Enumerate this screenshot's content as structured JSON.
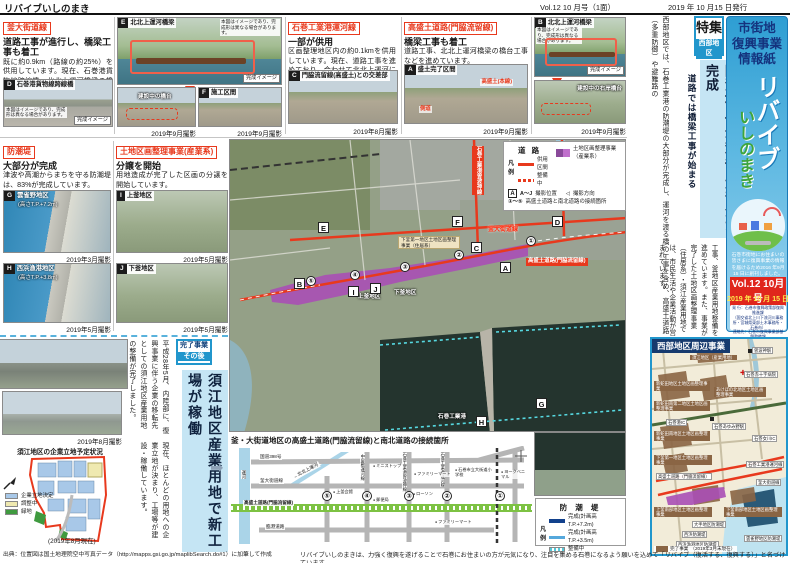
{
  "header": {
    "newsletter_name": "リバイブいしのまき",
    "volume": "Vol.12 10 月号（1面）",
    "issue_date": "2019 年 10 月15 日発行"
  },
  "articles": {
    "a1": {
      "label": "釜大街道線",
      "headline": "道路工事が進行し、橋梁工事も着工",
      "body": "既に約0.9km（路線の約25%）を供用しています。現在、石巻港貨物線跨線橋、北北上運河橋梁の橋台工事などを進めています。"
    },
    "a2": {
      "label": "石巻工業港運河線",
      "headline": "一部が供用",
      "body": "区画整理地区内の約0.1kmを供用しています。現在、道路工事を進めており、合わせて北北上運河に関わる橋梁の整備も進めています。"
    },
    "a3": {
      "label": "高盛土道路(門脇流留線)",
      "headline": "橋梁工事も着工",
      "body": "道路工事、北北上運河橋梁の橋台工事などを進めています。"
    },
    "a4": {
      "label": "防潮堤",
      "headline": "大部分が完成",
      "body": "津波や高潮からまちを守る防潮堤は、83%が完成しています。"
    },
    "a5": {
      "label": "土地区画整理事業(産業系)",
      "headline": "分譲を開始",
      "body": "用地造成が完了した区画の分譲を開始しています。"
    }
  },
  "photos": {
    "d": {
      "letter": "D",
      "title": "石巻港貨物線跨線橋",
      "note": "本図はイメージであり、完成形は異なる場合があります。",
      "tag": "完成イメージ"
    },
    "e": {
      "letter": "E",
      "title": "北北上運河橋梁",
      "note": "本図はイメージであり、完成形は異なる場合があります。",
      "tag": "完成イメージ",
      "sub": "建設中の橋台",
      "date": "2019年9月撮影"
    },
    "f": {
      "letter": "F",
      "title": "施工区間",
      "date": "2019年9月撮影"
    },
    "c": {
      "letter": "C",
      "title": "門脇流留線(高盛土)との交差部",
      "date": "2019年8月撮影"
    },
    "a": {
      "letter": "A",
      "title": "盛土完了区間",
      "label1": "高盛土(本線)",
      "label2": "側道",
      "date": "2019年9月撮影"
    },
    "b": {
      "letter": "B",
      "title": "北北上運河橋梁",
      "note": "本図はイメージであり、完成形は異なる場合があります。",
      "tag": "完成イメージ",
      "sub": "建設中の右岸橋台",
      "date": "2019年9月撮影"
    },
    "g": {
      "letter": "G",
      "title": "雲雀野地区",
      "height": "(高さT.P.+7.2m)",
      "date": "2019年3月撮影"
    },
    "h": {
      "letter": "H",
      "title": "西浜漁港地区",
      "height": "(高さT.P.+3.8m)",
      "date": "2019年5月撮影"
    },
    "i": {
      "letter": "I",
      "title": "上釜地区",
      "date": "2019年5月撮影"
    },
    "j": {
      "letter": "J",
      "title": "下釜地区",
      "date": "2019年5月撮影"
    }
  },
  "sue": {
    "badge_line1": "完了事業",
    "badge_line2": "その後",
    "headline": "須江地区産業用地で新工場が稼働",
    "body1": "平成28年5月、内陸部に、復興事業に伴う企業の移転先としての須江地区産業用地の整備が完了しました。",
    "body2": "現在、ほとんどの用地への企業立地が決まり、工場等が建設・稼働しています。",
    "photo_date": "2019年8月撮影",
    "diagram_title": "須江地区の企業立地予定状況",
    "legend": [
      {
        "label": "企業立地決定",
        "color": "#a8c8e8"
      },
      {
        "label": "調整中",
        "color": "#efe9b0"
      },
      {
        "label": "緑地",
        "color": "#3f9a3f"
      }
    ],
    "as_of": "(2019年8月現在)"
  },
  "sidebar": {
    "feature_tag": "特集",
    "feature_area": "西部地区",
    "headline_main": "防潮堤（工業港）大部分が完成",
    "headline_sub": "道路では橋梁工事が始まる",
    "body1": "西部地区では、石巻工業港の防潮堤の大部分が完成し、運河を渡る橋の工事を含め、高盛土道路（多重防御）や避難路の",
    "body2": "工事、釜地区産業用地整備を進めています。また、事業が完了した土地区画整理事業（住居系）・須江産業用地では、市民生活や企業活動が営まれています。"
  },
  "masthead": {
    "kicker1": "市街地",
    "kicker2": "復興事業",
    "kicker3": "情報紙",
    "title_main": "リバイブ",
    "title_sub": "いしのまき",
    "founding_note": "石巻市街地にお住まいの皆さまに復興事業の情報を届けるため2016 年9月15 日に創刊しました。",
    "vol_badge": "Vol.12 10月号",
    "issue_date": "2019 年 10 月 15 日発行",
    "publisher1": "発 行：石巻市復興政策部復興推進課",
    "publisher2": "（国交省北上川下流河川事務所・宮城県東部土木事務所・石巻市）",
    "publisher3": "連絡先：石巻市復興事業部基盤整備課",
    "publisher4": "☎0225-95-1111",
    "publisher5": "（内線）5516"
  },
  "main_map": {
    "legend": {
      "road_title": "道 路",
      "hanrei1": "凡",
      "hanrei2": "例",
      "in_service": "供用区間",
      "under_construction": "整備中",
      "land_readjustment": "土地区画整理事業（産業系）",
      "photo_range": "A～J",
      "photo_pos": "撮影位置",
      "photo_dir": "撮影方向",
      "number_range": "①～⑤",
      "connection": "高盛土道路と南北道路の接続箇所"
    },
    "seawall_legend": {
      "title": "防 潮 堤",
      "hanrei1": "凡",
      "hanrei2": "例",
      "done_high": "完成(計画高T.P.+7.2m)",
      "done_low": "完成(計画高T.P.+3.5m)",
      "under_construction": "整備中"
    },
    "labels": {
      "kama": "釜大街道線",
      "takamori": "高盛土道路(門脇流留線)",
      "unga_line": "石巻工業港運河線",
      "sobanokami_line": "石巻工業港曽波神線",
      "shimogama_lr": "下釜第一地区土地区画整理事業（住居系）",
      "kamigama_area": "上釜地区",
      "shimogama_area": "下釜地区",
      "port": "石巻工業港"
    },
    "markers": [
      "A",
      "B",
      "C",
      "D",
      "E",
      "F",
      "G",
      "H",
      "I",
      "J"
    ],
    "circled": [
      "①",
      "②",
      "③",
      "④",
      "⑤"
    ]
  },
  "schematic": {
    "title": "釜・大街道地区の高盛土道路(門脇流留線)と南北道路の接続箇所",
    "roads": {
      "r398": "国道398号",
      "kama": "釜大街道線",
      "takamori": "高盛土道路(門脇流留線)",
      "rinko": "臨港道路",
      "unga": "運河",
      "kitakami": "←北北上運河",
      "v1": "中屋敷運河線",
      "v2": "石巻工業港曽波神線",
      "v3": "石巻工業港運河線"
    },
    "pois": [
      "ミニストップ",
      "ファミリーマート",
      "ローソン",
      "上釜会館",
      "郵便局",
      "石巻市立大街道小学校",
      "ヨークベニマル",
      "ファミリーマート"
    ]
  },
  "west_map": {
    "title": "西部地区周辺事業",
    "legend_label": "完了事業",
    "legend_as_of": "（2019年3月末現在）",
    "labels": [
      "須江地区（産業用地）",
      "曽波神駅",
      "石巻赤十字病院",
      "新蛇田地区土地区画整理事業",
      "あけぼの北地区土地区画整理事業",
      "新蛇田南第二地区土地区画整理事業",
      "新蛇田南地区土地区画整理事業",
      "石巻港IC",
      "石巻あゆみ野駅",
      "下釜第一地区土地区画整理事業",
      "高盛土道路（門脇流留線）",
      "石巻工業港運河線",
      "釜大街道線",
      "上釜南部地区土地区画整理事業",
      "下釜南部地区土地区画整理事業",
      "大手地区防潮堤",
      "西浜防潮堤",
      "西浜漁港地区防潮堤",
      "雲雀野地区防潮堤",
      "石巻女川IC"
    ]
  },
  "footer": {
    "source": "出典：位置図は国土地理院空中写真データ（http://mapps.gsi.go.jp/maplibSearch.do#1）に加筆して作成",
    "tagline": "リバイブいしのまきは、力強く復興を遂げることで石巻にお住まいの方が元気になり、注目を集める石巻になるよう願いを込めて「リバイブ（復活する、復興する）」と名づけています。"
  }
}
